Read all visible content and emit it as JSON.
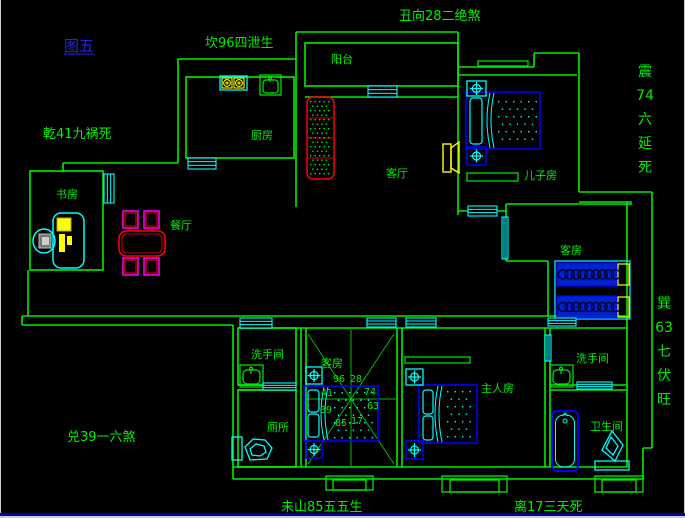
{
  "figure_label": {
    "text": "图五",
    "x": 64,
    "y": 51,
    "color": "#2222ff"
  },
  "annotations": [
    {
      "name": "kan",
      "text": "坎96四泄生",
      "x": 205,
      "y": 47,
      "vertical": false
    },
    {
      "name": "chou",
      "text": "丑向28二绝煞",
      "x": 399,
      "y": 20,
      "vertical": false
    },
    {
      "name": "qian",
      "text": "乾41九祸死",
      "x": 43,
      "y": 138,
      "vertical": false
    },
    {
      "name": "dui",
      "text": "兑39一六煞",
      "x": 67,
      "y": 441,
      "vertical": false
    },
    {
      "name": "wei",
      "text": "未山85五五生",
      "x": 281,
      "y": 511,
      "vertical": false
    },
    {
      "name": "li",
      "text": "离17三天死",
      "x": 514,
      "y": 511,
      "vertical": false
    },
    {
      "name": "zhen",
      "text": "震74六延死",
      "x": 645,
      "y": 76,
      "vertical": true,
      "units": [
        "震",
        "74",
        "六",
        "延",
        "死"
      ],
      "dy": 24
    },
    {
      "name": "xun",
      "text": "巽63七伏旺",
      "x": 664,
      "y": 308,
      "vertical": true,
      "units": [
        "巽",
        "63",
        "七",
        "伏",
        "旺"
      ],
      "dy": 24
    }
  ],
  "rooms": [
    {
      "name": "balcony",
      "label": "阳台",
      "x": 331,
      "y": 63
    },
    {
      "name": "kitchen",
      "label": "厨房",
      "x": 251,
      "y": 139
    },
    {
      "name": "study",
      "label": "书房",
      "x": 56,
      "y": 198
    },
    {
      "name": "dining",
      "label": "餐厅",
      "x": 170,
      "y": 229
    },
    {
      "name": "living",
      "label": "客厅",
      "x": 386,
      "y": 177
    },
    {
      "name": "kids-room",
      "label": "儿子房",
      "x": 524,
      "y": 179
    },
    {
      "name": "guest-room-upper",
      "label": "客房",
      "x": 560,
      "y": 254
    },
    {
      "name": "washroom-left",
      "label": "洗手间",
      "x": 251,
      "y": 358
    },
    {
      "name": "toilet-room",
      "label": "厕所",
      "x": 267,
      "y": 431
    },
    {
      "name": "guest-room-lower",
      "label": "客房",
      "x": 321,
      "y": 367
    },
    {
      "name": "master-room",
      "label": "主人房",
      "x": 481,
      "y": 392
    },
    {
      "name": "washroom-right",
      "label": "洗手间",
      "x": 576,
      "y": 362
    },
    {
      "name": "bathroom",
      "label": "卫生间",
      "x": 590,
      "y": 430
    }
  ],
  "compass_numbers": [
    {
      "v": "96",
      "x": 333,
      "y": 382
    },
    {
      "v": "28",
      "x": 350,
      "y": 382
    },
    {
      "v": "41",
      "x": 321,
      "y": 396
    },
    {
      "v": "74",
      "x": 364,
      "y": 395
    },
    {
      "v": "39",
      "x": 320,
      "y": 413
    },
    {
      "v": "63",
      "x": 367,
      "y": 409
    },
    {
      "v": "85",
      "x": 335,
      "y": 426
    },
    {
      "v": "17",
      "x": 351,
      "y": 424
    }
  ],
  "colors": {
    "background": "#000000",
    "wall_green": "#00ee00",
    "window_cyan": "#00ffff",
    "furniture_blue": "#0000ff",
    "bed_fill_blue": "#0022cc",
    "accent_yellow": "#ffff00",
    "accent_red": "#ff0000",
    "accent_magenta": "#ff00ff",
    "text_green": "#00ee00",
    "figure_blue": "#2222ff",
    "statusbar_blue": "#0000bb",
    "edge_white": "#cccccc"
  }
}
